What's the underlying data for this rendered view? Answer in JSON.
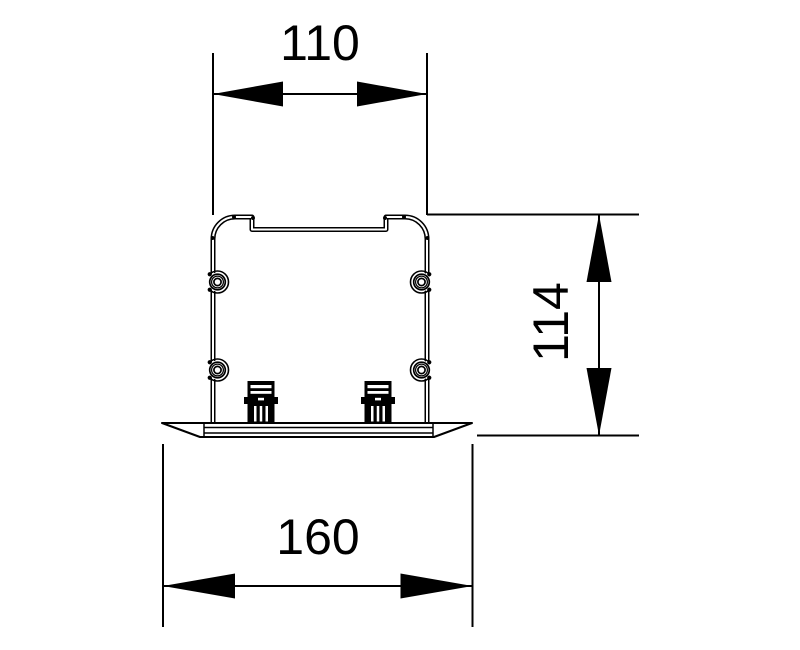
{
  "drawing": {
    "type": "technical-drawing-cross-section",
    "dimensions": {
      "top_width": {
        "label": "110"
      },
      "right_height": {
        "label": "114"
      },
      "bottom_width": {
        "label": "160"
      }
    },
    "colors": {
      "line": "#000000",
      "background": "#ffffff"
    }
  }
}
